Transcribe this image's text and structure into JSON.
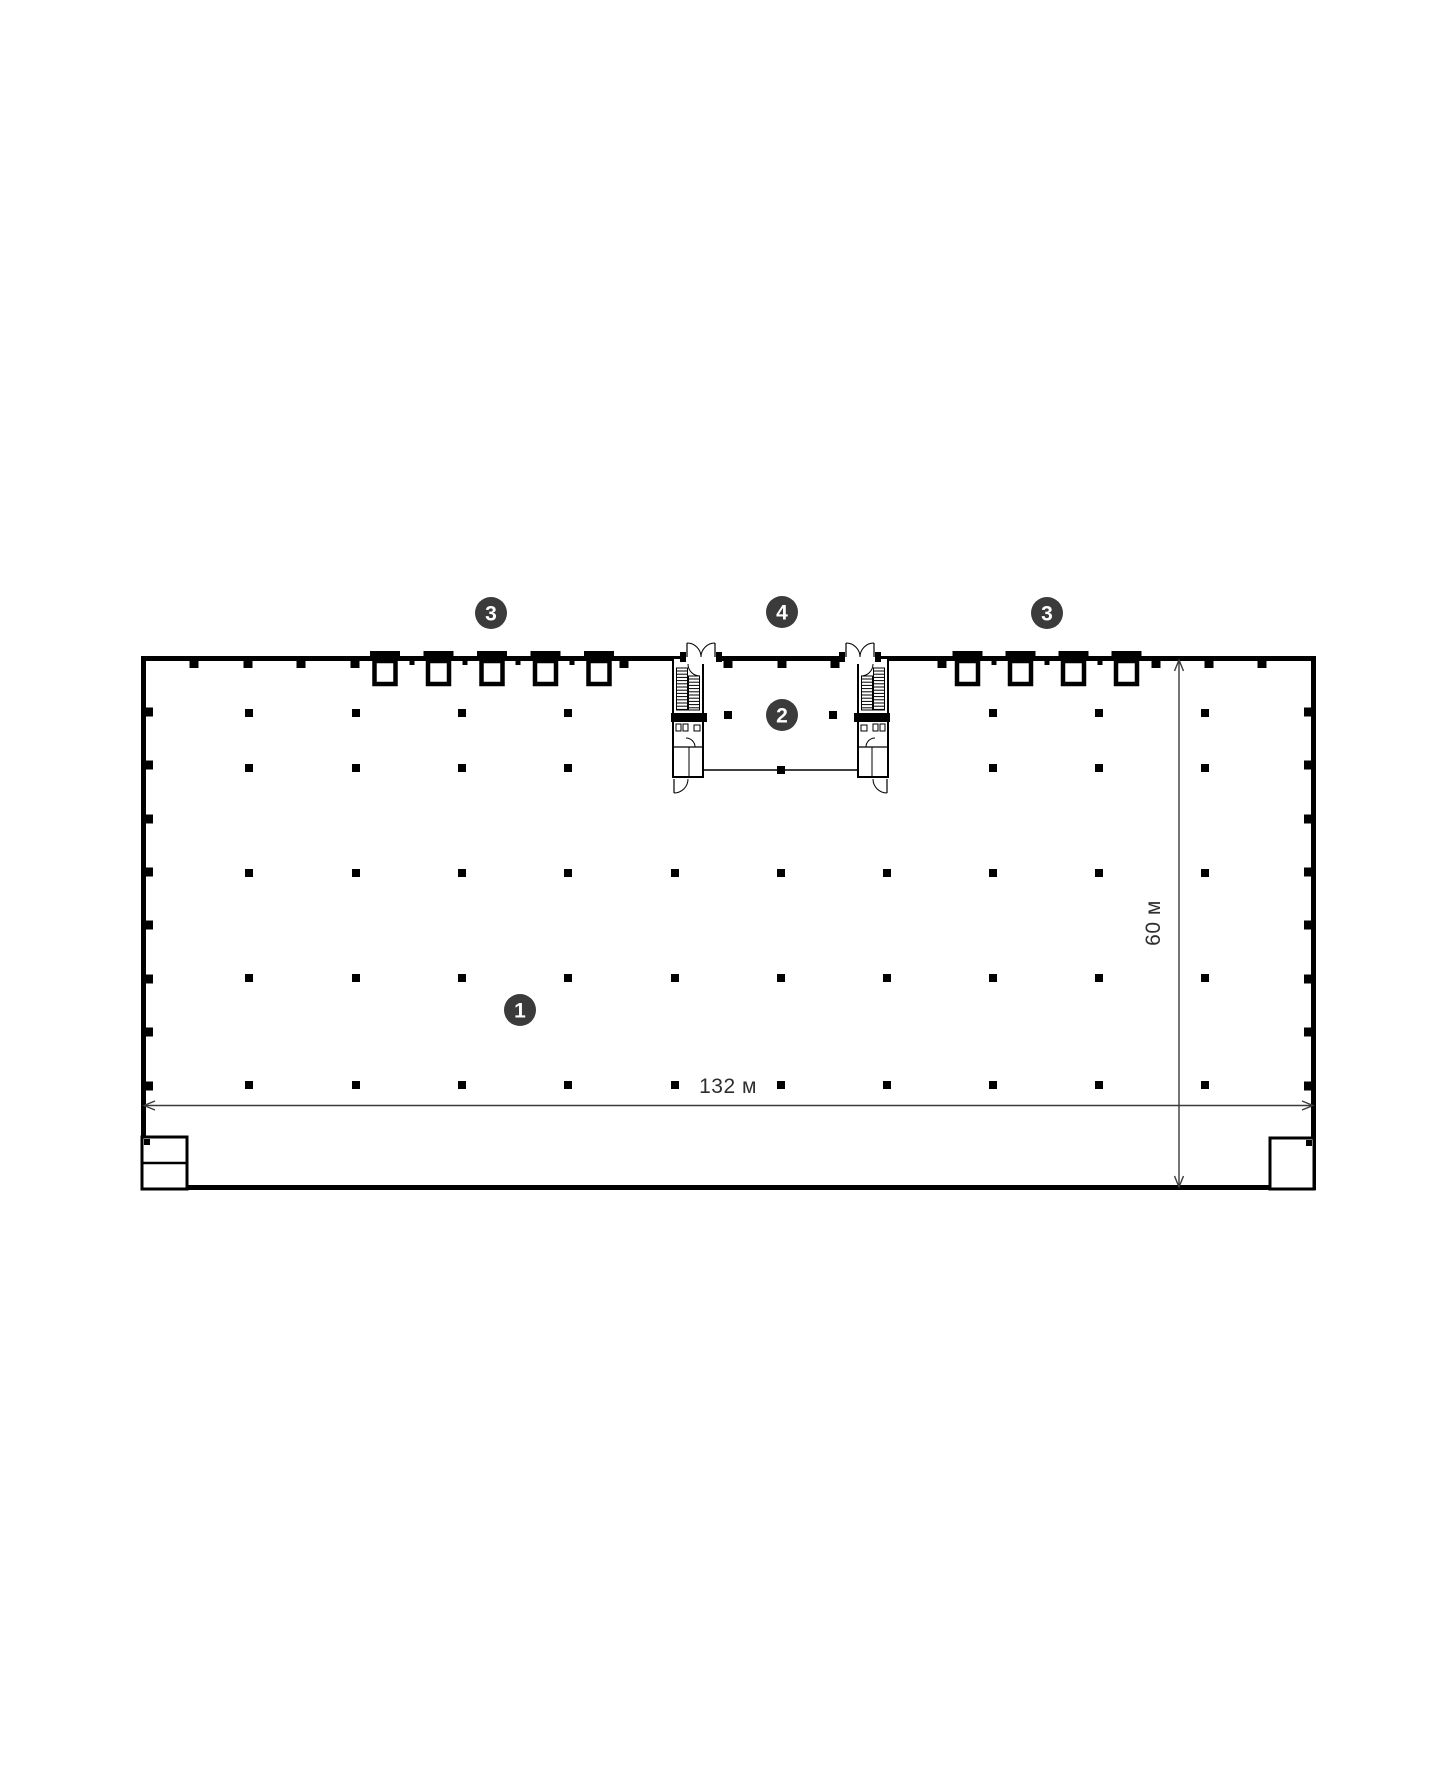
{
  "markers": [
    {
      "label": "1",
      "x": 520,
      "y": 1010
    },
    {
      "label": "2",
      "x": 782,
      "y": 715
    },
    {
      "label": "3",
      "x": 491,
      "y": 613
    },
    {
      "label": "4",
      "x": 782,
      "y": 612
    },
    {
      "label": "3",
      "x": 1047,
      "y": 613
    }
  ],
  "dimensions": {
    "width_label": "132 м",
    "height_label": "60 м",
    "width_m": 132,
    "height_m": 60
  },
  "colors": {
    "bg": "#ffffff",
    "line": "#000000",
    "marker_bg": "#3b3b3b",
    "marker_text": "#ffffff",
    "dim_line": "#3a3a3a"
  },
  "plan": {
    "canvas": {
      "w": 1440,
      "h": 1776
    },
    "building": {
      "x": 141,
      "y": 656,
      "w": 1175,
      "h": 534,
      "wall": 5
    },
    "dock_doors": {
      "left_centers": [
        385,
        438.5,
        492,
        545.5,
        599
      ],
      "right_centers": [
        967.5,
        1020.5,
        1073.5,
        1126.5
      ]
    },
    "pilasters_top_normal": [
      194,
      248,
      301,
      355,
      624,
      728,
      782,
      835,
      942,
      1156,
      1209,
      1262
    ],
    "pilasters_top_small": [
      412,
      465,
      518,
      572,
      994,
      1047,
      1100
    ],
    "side_pilaster_ys": [
      712,
      765,
      819,
      872,
      925,
      979,
      1032,
      1086
    ],
    "grid": {
      "column_xs": [
        249,
        356,
        462,
        568,
        675,
        781,
        887,
        993,
        1099,
        1205
      ],
      "rows_full": [
        873,
        978,
        1085
      ],
      "rows_partial": [
        713,
        768
      ],
      "partial_xs": [
        249,
        356,
        462,
        568,
        993,
        1099,
        1205
      ],
      "lobby_columns": [
        [
          728,
          715
        ],
        [
          833,
          715
        ]
      ]
    },
    "core": {
      "left_x": 673,
      "width": 30,
      "top": 658,
      "bottom": 777,
      "mirror_axis": 1561,
      "entry": [
        686,
        716
      ],
      "lobby_line_y": 770,
      "lobby_x1": 703,
      "lobby_x2": 858,
      "lobby_tick_x": 781
    },
    "utility_left": {
      "x": 142,
      "y": 1137,
      "w": 45,
      "h": 52,
      "divider_y": 1163
    },
    "utility_right": {
      "x": 1270,
      "y": 1138,
      "w": 44,
      "h": 51
    },
    "dim_h": {
      "y": 1105.5,
      "x1": 144,
      "x2": 1313,
      "label_x": 728,
      "label_y": 1093
    },
    "dim_v": {
      "x": 1179,
      "y1": 660,
      "y2": 1187,
      "label_x": 1160,
      "label_y": 923
    }
  }
}
